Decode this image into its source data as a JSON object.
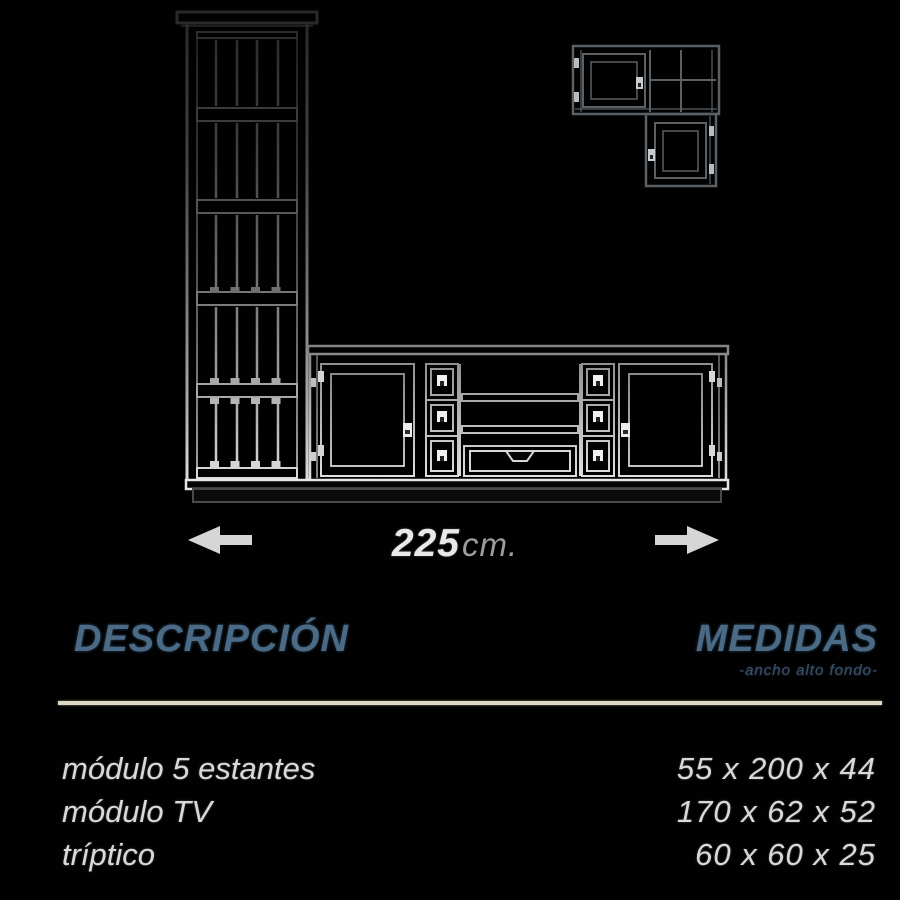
{
  "canvas": {
    "background": "#010101"
  },
  "diagram": {
    "dimension_label": {
      "value": "225",
      "unit": "cm."
    },
    "colors": {
      "line_dim": "#2a2a2a",
      "line_mid": "#787878",
      "line_bright": "#e6e6e6",
      "arrow": "#d6d6d6"
    }
  },
  "table": {
    "header": {
      "description": "DESCRIPCIÓN",
      "measures": "MEDIDAS",
      "measures_subtitle": "-ancho alto fondo-"
    },
    "accent_color": "#4a6a85",
    "divider_color": "#ded7c4",
    "text_color": "#d9d9d9",
    "rows": [
      {
        "name": "módulo 5 estantes",
        "size": "55 x 200 x 44"
      },
      {
        "name": "módulo TV",
        "size": "170 x 62 x 52"
      },
      {
        "name": "tríptico",
        "size": "60 x 60 x 25"
      }
    ]
  }
}
